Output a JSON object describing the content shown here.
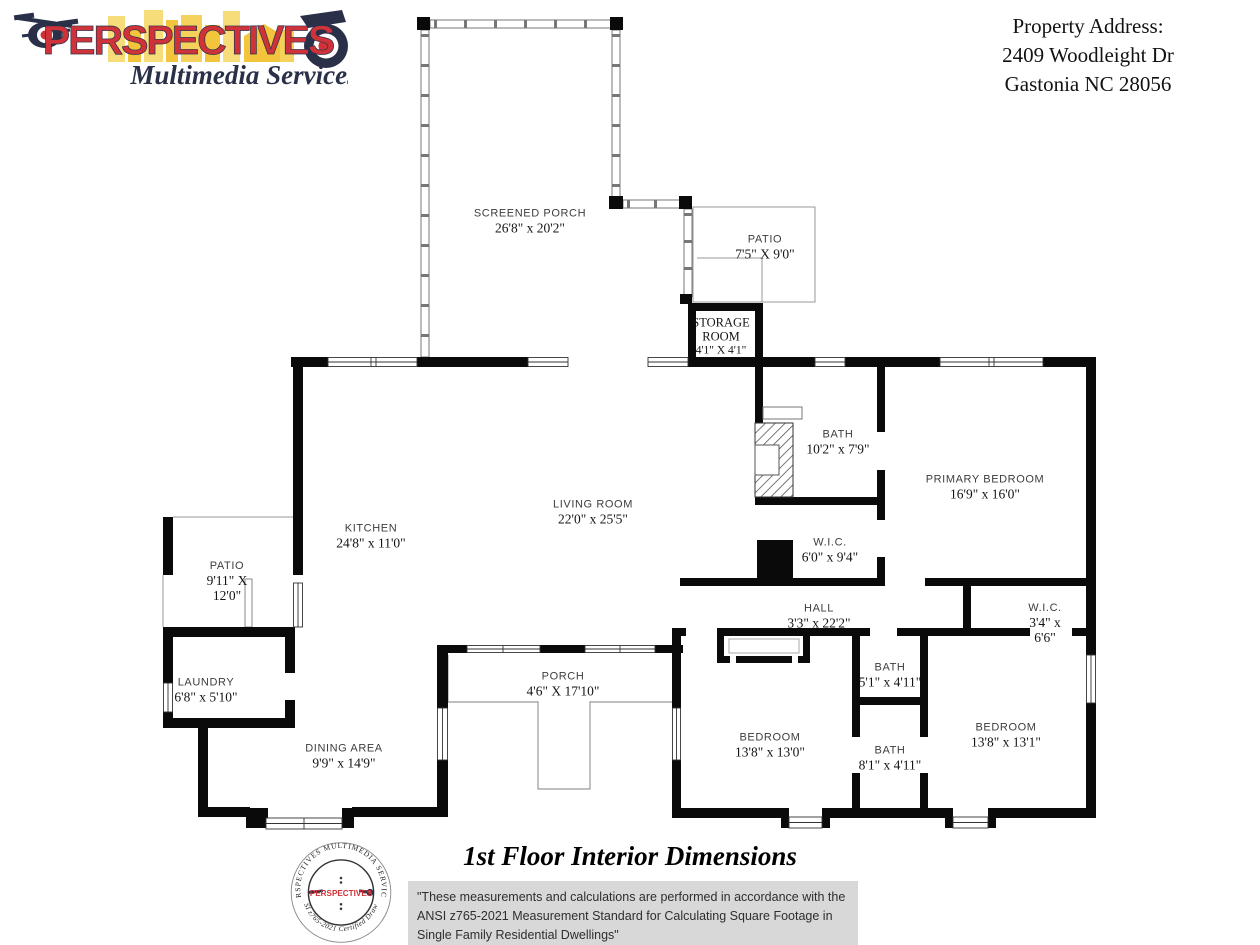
{
  "header": {
    "logo": {
      "brand": "PERSPECTIVES",
      "tagline": "Multimedia Services"
    },
    "address": {
      "line1": "Property Address:",
      "line2": "2409 Woodleight Dr",
      "line3": "Gastonia NC 28056"
    }
  },
  "rooms": [
    {
      "lines": [
        "SCREENED PORCH",
        "26'8\" x 20'2\""
      ]
    },
    {
      "lines": [
        "PATIO",
        "7'5\" X 9'0\""
      ]
    },
    {
      "lines": [
        "STORAGE",
        "ROOM",
        "4'1\" X 4'1\""
      ]
    },
    {
      "lines": [
        "KITCHEN",
        "24'8\" x 11'0\""
      ]
    },
    {
      "lines": [
        "LIVING ROOM",
        "22'0\" x 25'5\""
      ]
    },
    {
      "lines": [
        "BATH",
        "10'2\" x 7'9\""
      ]
    },
    {
      "lines": [
        "PRIMARY BEDROOM",
        "16'9\" x 16'0\""
      ]
    },
    {
      "lines": [
        "W.I.C.",
        "6'0\" x 9'4\""
      ]
    },
    {
      "lines": [
        "PATIO",
        "9'11\" X",
        "12'0\""
      ]
    },
    {
      "lines": [
        "LAUNDRY",
        "6'8\" x 5'10\""
      ]
    },
    {
      "lines": [
        "HALL",
        "3'3\" x 22'2\""
      ]
    },
    {
      "lines": [
        "W.I.C.",
        "3'4\" x",
        "6'6\""
      ]
    },
    {
      "lines": [
        "DINING AREA",
        "9'9\" x 14'9\""
      ]
    },
    {
      "lines": [
        "PORCH",
        "4'6\" X 17'10\""
      ]
    },
    {
      "lines": [
        "BEDROOM",
        "13'8\" x 13'0\""
      ]
    },
    {
      "lines": [
        "BATH",
        "5'1\" x 4'11\""
      ]
    },
    {
      "lines": [
        "BATH",
        "8'1\" x 4'11\""
      ]
    },
    {
      "lines": [
        "BEDROOM",
        "13'8\" x 13'1\""
      ]
    }
  ],
  "footer": {
    "title": "1st Floor Interior Dimensions",
    "disclaimer": "\"These measurements and calculations are performed in accordance with the ANSI z765-2021 Measurement Standard for Calculating Square Footage in Single Family Residential Dwellings\"",
    "seal": {
      "top": "PERSPECTIVES MULTIMEDIA SERVICES",
      "bottom": "ANSI z765-2021 Certified Drawing",
      "center": "PERSPECTIVES"
    }
  },
  "colors": {
    "brand_red": "#cf3339",
    "brand_navy": "#2b3049",
    "brand_yellow": "#f2c53d",
    "wall": "#0a0a0a",
    "disclaimer_bg": "#d8d8d8"
  }
}
